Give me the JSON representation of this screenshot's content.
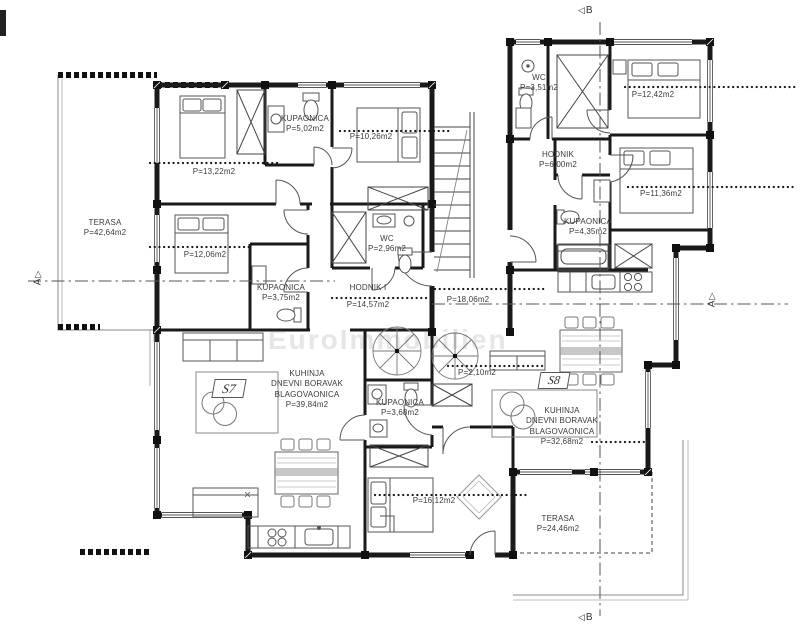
{
  "plan": {
    "watermark": "EuroImmobilien",
    "units": {
      "s7": "S7",
      "s8": "S8"
    },
    "markers": {
      "top": "B",
      "bottom": "B",
      "left": "A",
      "right": "A"
    },
    "icons": {
      "section_arrow_left": "◁",
      "section_arrow_up": "▷"
    },
    "colors": {
      "wall_ink": "#1a1a1a",
      "label_ink": "#3a3a3a",
      "paper": "#ffffff"
    },
    "rooms": {
      "terasa_s7": {
        "name": "TERASA",
        "area": "P=42,64m2"
      },
      "bed1_s7": {
        "area": "P=13,22m2"
      },
      "kup1_s7": {
        "name": "KUPAONICA",
        "area": "P=5,02m2"
      },
      "bed2_s7": {
        "area": "P=10,26m2"
      },
      "bed3_s7": {
        "area": "P=12,06m2"
      },
      "kup2_s7": {
        "name": "KUPAONICA",
        "area": "P=3,75m2"
      },
      "wc_s7": {
        "name": "WC",
        "area": "P=2,96m2"
      },
      "hodnik_s7": {
        "name": "HODNIK I",
        "area": "P=14,57m2"
      },
      "living_s7": {
        "l1": "KUHINJA",
        "l2": "DNEVNI BORAVAK",
        "l3": "BLAGOVAONICA",
        "area": "P=39,84m2"
      },
      "wc_s8": {
        "name": "WC",
        "area": "P=3,51m2"
      },
      "bed1_s8": {
        "area": "P=12,42m2"
      },
      "hodnik_s8": {
        "name": "HODNIK",
        "area": "P=6,00m2"
      },
      "bed2_s8": {
        "area": "P=11,36m2"
      },
      "kup1_s8": {
        "name": "KUPAONICA",
        "area": "P=4,35m2"
      },
      "hall_s8": {
        "area": "P=18,06m2"
      },
      "stair_s8": {
        "area": "P=2,10m2"
      },
      "kup2_s8": {
        "name": "KUPAONICA",
        "area": "P=3,68m2"
      },
      "living_s8": {
        "l1": "KUHINJA",
        "l2": "DNEVNI BORAVAK",
        "l3": "BLAGOVAONICA",
        "area": "P=32,68m2"
      },
      "bed3_s8": {
        "area": "P=16,12m2"
      },
      "terasa_s8": {
        "name": "TERASA",
        "area": "P=24,46m2"
      }
    }
  }
}
